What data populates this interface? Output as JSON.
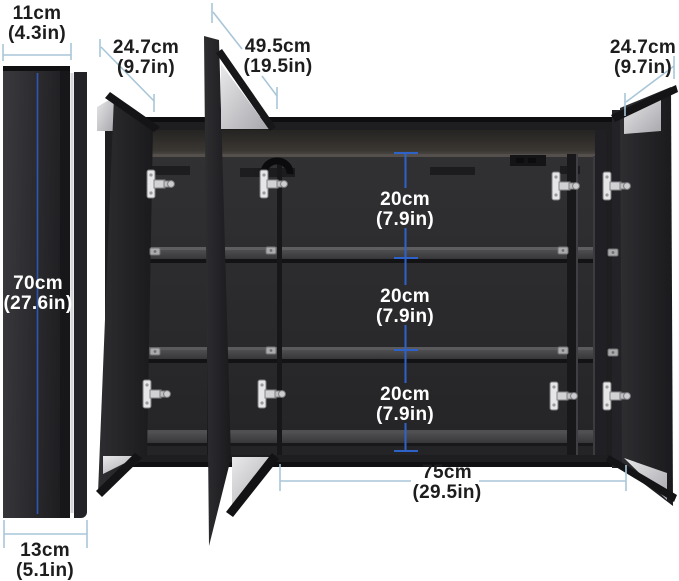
{
  "diagram": {
    "description": "Three-door mirrored medicine cabinet dimension diagram, side profile view and open front view",
    "labels": {
      "side_width": {
        "cm": "11cm",
        "inch": "(4.3in)"
      },
      "left_door": {
        "cm": "24.7cm",
        "inch": "(9.7in)"
      },
      "middle_door": {
        "cm": "49.5cm",
        "inch": "(19.5in)"
      },
      "right_door": {
        "cm": "24.7cm",
        "inch": "(9.7in)"
      },
      "height": {
        "cm": "70cm",
        "inch": "(27.6in)"
      },
      "depth": {
        "cm": "13cm",
        "inch": "(5.1in)"
      },
      "shelf_gap_top": {
        "cm": "20cm",
        "inch": "(7.9in)"
      },
      "shelf_gap_middle": {
        "cm": "20cm",
        "inch": "(7.9in)"
      },
      "shelf_gap_bottom": {
        "cm": "20cm",
        "inch": "(7.9in)"
      },
      "width": {
        "cm": "75cm",
        "inch": "(29.5in)"
      }
    },
    "colors": {
      "background": "#ffffff",
      "cabinet_dark": "#232326",
      "mirror_gray": "#c9c9cc",
      "interior_dimension_blue": "#2e62c8",
      "leader_line_blue": "#a9c6d8",
      "text_dark": "#1d1d1d",
      "text_light": "#ffffff",
      "hinge_silver": "#d8d8da"
    }
  }
}
